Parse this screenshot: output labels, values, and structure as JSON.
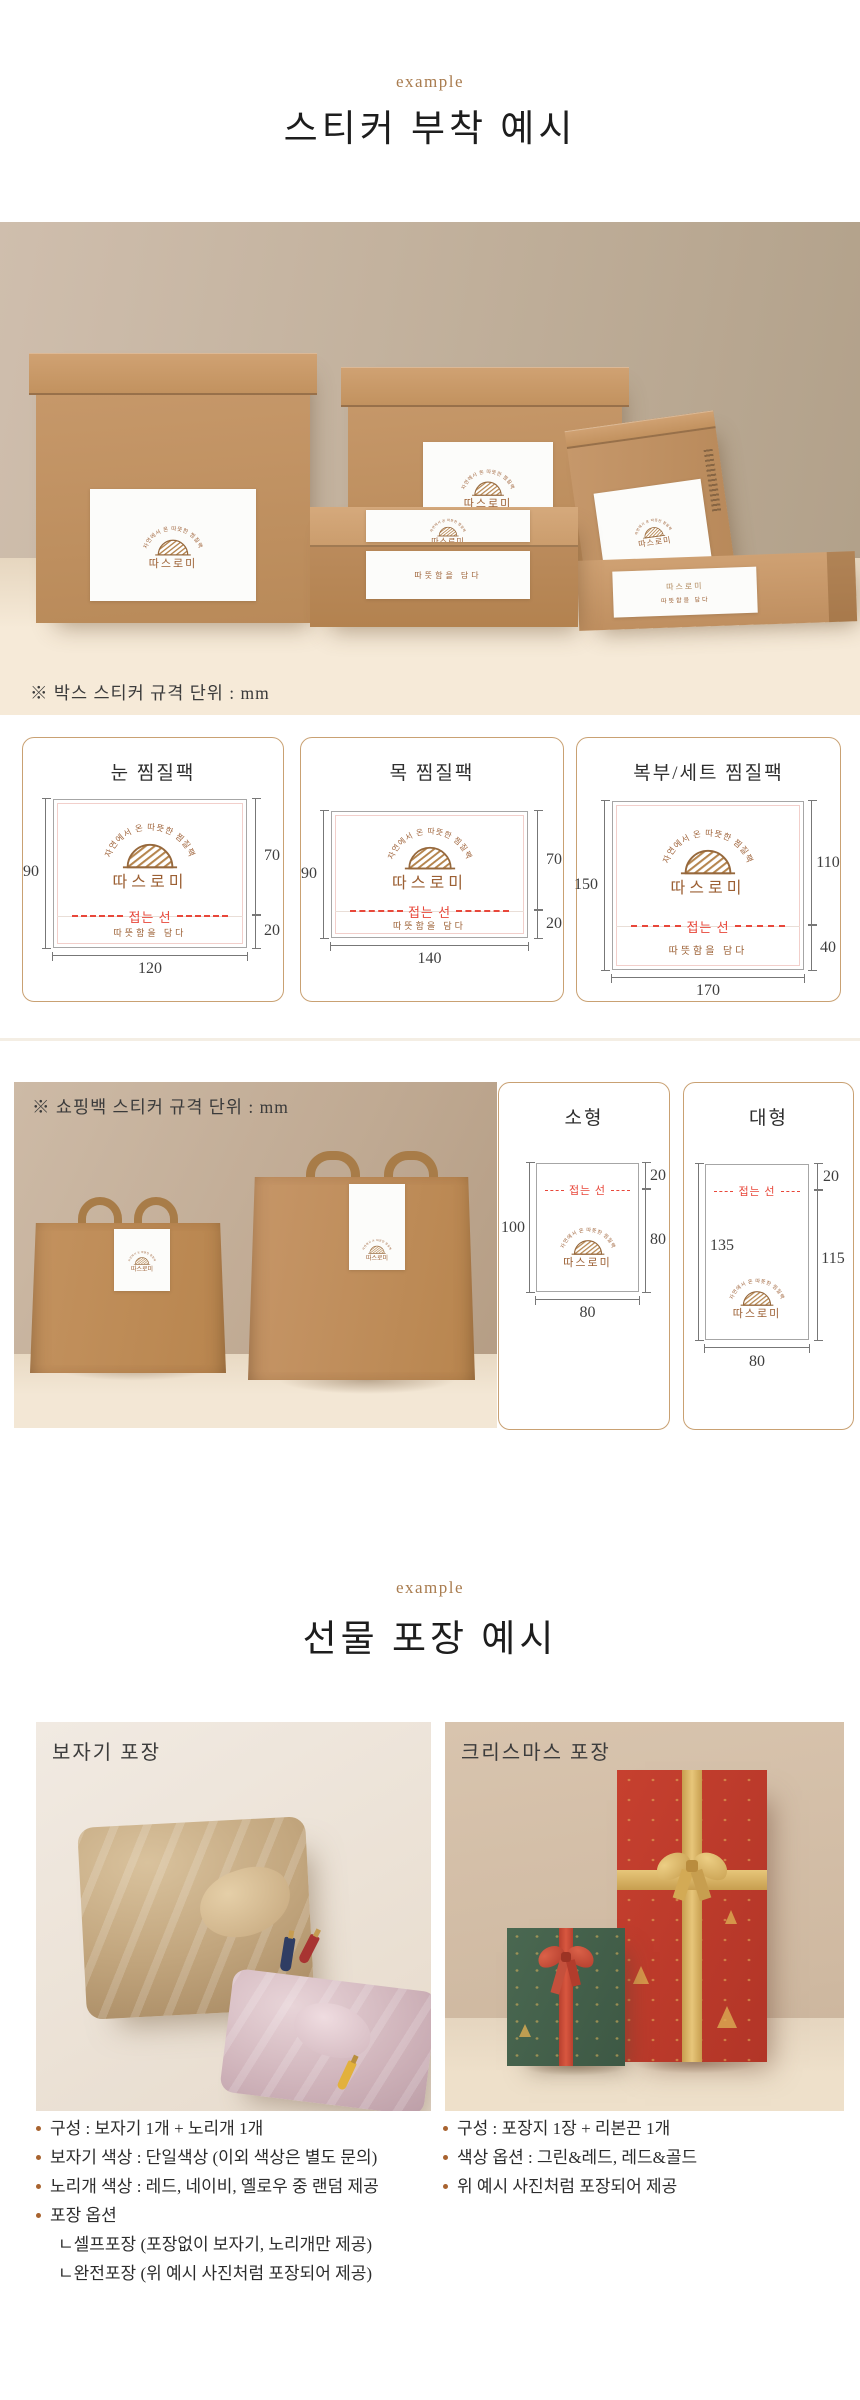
{
  "brand_sticker": {
    "arc_text": "자연에서 온 따뜻한 찜질팩",
    "brand": "따스로미",
    "fold_label": "접는 선",
    "tagline": "따뜻함을 담다"
  },
  "section_sticker": {
    "eyebrow": "example",
    "title": "스티커 부착 예시",
    "box_note": "※ 박스 스티커 규격 단위 : mm",
    "box_cards": [
      {
        "title": "눈 찜질팩",
        "left": "90",
        "right_top": "70",
        "right_bottom": "20",
        "width": "120"
      },
      {
        "title": "목 찜질팩",
        "left": "90",
        "right_top": "70",
        "right_bottom": "20",
        "width": "140"
      },
      {
        "title": "복부/세트 찜질팩",
        "left": "150",
        "right_top": "110",
        "right_bottom": "40",
        "width": "170"
      }
    ],
    "bag_note": "※ 쇼핑백 스티커 규격 단위 : mm",
    "bag_cards": [
      {
        "title": "소형",
        "left": "100",
        "right_top": "20",
        "right_bottom": "80",
        "width": "80"
      },
      {
        "title": "대형",
        "left": "135",
        "right_top": "20",
        "right_bottom": "115",
        "width": "80"
      }
    ]
  },
  "section_gift": {
    "eyebrow": "example",
    "title": "선물 포장 예시",
    "bojagi": {
      "label": "보자기 포장",
      "bullets": [
        "구성 : 보자기 1개 + 노리개 1개",
        "보자기 색상 : 단일색상 (이외 색상은 별도 문의)",
        "노리개 색상 : 레드, 네이비, 옐로우 중 랜덤 제공",
        "포장 옵션"
      ],
      "sub_bullets": [
        "ㄴ셀프포장 (포장없이 보자기, 노리개만 제공)",
        "ㄴ완전포장 (위 예시 사진처럼 포장되어 제공)"
      ]
    },
    "christmas": {
      "label": "크리스마스 포장",
      "bullets": [
        "구성 : 포장지 1장 + 리본끈 1개",
        "색상 옵션 : 그린&레드, 레드&골드",
        "위 예시 사진처럼 포장되어 제공"
      ]
    }
  },
  "colors": {
    "eyebrow": "#a97c4f",
    "logo_brown": "#9c6034",
    "fold_red": "#e8473a",
    "card_border": "#c9a173",
    "bullet_dot": "#a8632f"
  }
}
